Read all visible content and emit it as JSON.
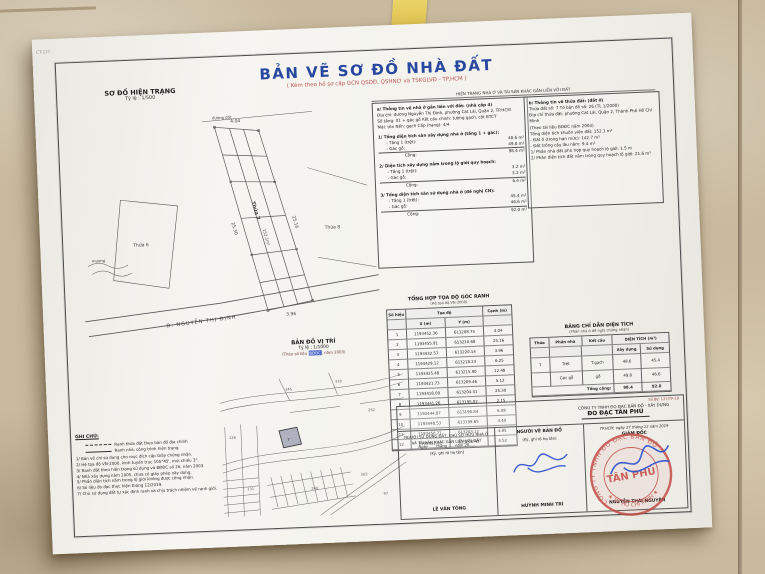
{
  "colors": {
    "title_blue": "#28479e",
    "accent_red": "#b9534f",
    "stamp_red": "#c0453e",
    "sig_blue": "#2b4fd0",
    "hl_blue": "#4a66c8"
  },
  "document": {
    "corner_mark": "CT-127",
    "title": "BẢN VẼ SƠ ĐỒ NHÀ ĐẤT",
    "subtitle": "( Kèm theo hồ sơ cấp GCN QSDĐ, QSHNƠ và TSKGLVĐ - TP.HCM )"
  },
  "hien_trang": {
    "heading": "SƠ ĐỒ HIỆN TRẠNG",
    "scale": "Tỷ lệ : 1/500",
    "plan": {
      "road_name": "Đ. NGUYỄN THỊ ĐỊNH",
      "parcel_label": "Thửa 7",
      "parcel_area": "152.1m²",
      "neighbor_left": "Thửa 6",
      "neighbor_right": "Thửa 8",
      "top_label": "đường đất",
      "ditch_label": "mương",
      "dim_top": "4.04",
      "dim_right": "25.16",
      "dim_left": "25.30",
      "dim_bottom": "3.96"
    }
  },
  "info_header": "HIỆN TRẠNG NHÀ Ở VÀ TÀI SẢN KHÁC GẮN LIỀN VỚI ĐẤT",
  "house_info": {
    "title": "a/ Thông tin về nhà ở gắn liền với đất: (nhà cấp 4)",
    "lines": [
      "Địa chỉ: đường Nguyễn Thị Định, phường Cát Lái, Quận 2, TP.HCM",
      "Số tầng: 01 + gác gỗ     Kết cấu chính: tường gạch, cột BTCT",
      "Mái: tôn     Nền: gạch     Cấp (hạng): 4/4"
    ],
    "blocks": [
      {
        "title": "1/ Tổng diện tích sàn xây dựng nhà ở (tầng 1 + gác):",
        "r1_label": "- Tầng 1 (trệt):",
        "r1_val": "48.6 m²",
        "r2_label": "- Gác gỗ:",
        "r2_val": "49.8 m²",
        "total_label": "Cộng:",
        "total": "98.4 m²"
      },
      {
        "title": "2/ Diện tích xây dựng nằm trong lộ giới quy hoạch:",
        "r1_label": "- Tầng 1 (trệt):",
        "r1_val": "3.2 m²",
        "r2_label": "- Gác gỗ:",
        "r2_val": "3.2 m²",
        "total_label": "Cộng:",
        "total": "6.4 m²"
      },
      {
        "title": "3/ Tổng diện tích sàn sử dụng nhà ở (đề nghị CN):",
        "r1_label": "- Tầng 1 (trệt):",
        "r1_val": "45.4 m²",
        "r2_label": "- Gác gỗ:",
        "r2_val": "46.6 m²",
        "total_label": "Cộng:",
        "total": "92.0 m²"
      }
    ]
  },
  "land_info": {
    "title": "b/ Thông tin về thửa đất: (đất ở)",
    "lines": [
      "Thửa đất số: 7      Tờ bản đồ số: 26 (TL 1/2000)",
      "Địa chỉ thửa đất: phường Cát Lái, Quận 2, Thành Phố Hồ Chí Minh",
      "(Theo tài liệu BĐĐC năm 2003)",
      "Tổng diện tích khuôn viên đất:  152.1 m²",
      "- Đất ở (trong hạn mức):  142.7 m²",
      "- Đất trồng cây lâu năm:  9.4 m²",
      "1/ Phần nhà đất phù hợp quy hoạch lộ giới:  1.5 m",
      "2/ Phần diện tích đất nằm trong quy hoạch lộ giới:  21.6 m²"
    ]
  },
  "coord_table": {
    "title": "TỔNG HỢP TỌA ĐỘ GÓC RANH",
    "subtitle": "(Hệ tọa độ VN-2000)",
    "headers": {
      "point": "Số hiệu",
      "coords": "Tọa độ",
      "x": "X (m)",
      "y": "Y (m)",
      "edge": "Cạnh (m)"
    },
    "rows": [
      {
        "n": "1",
        "x": "1193452.36",
        "y": "613208.75",
        "e": "4.04"
      },
      {
        "n": "2",
        "x": "1193455.91",
        "y": "613210.68",
        "e": "25.16"
      },
      {
        "n": "3",
        "x": "1193432.57",
        "y": "613220.14",
        "e": "3.96"
      },
      {
        "n": "4",
        "x": "1193429.12",
        "y": "613218.23",
        "e": "6.25"
      },
      {
        "n": "5",
        "x": "1193425.48",
        "y": "613215.90",
        "e": "12.48"
      },
      {
        "n": "6",
        "x": "1193421.73",
        "y": "613209.46",
        "e": "5.12"
      },
      {
        "n": "7",
        "x": "1193418.09",
        "y": "613204.31",
        "e": "25.30"
      },
      {
        "n": "8",
        "x": "1193441.26",
        "y": "613195.02",
        "e": "2.15"
      },
      {
        "n": "9",
        "x": "1193444.87",
        "y": "613196.84",
        "e": "6.08"
      },
      {
        "n": "10",
        "x": "1193448.53",
        "y": "613199.65",
        "e": "3.40"
      },
      {
        "n": "11",
        "x": "1193450.71",
        "y": "613203.12",
        "e": "4.85"
      },
      {
        "n": "12",
        "x": "1193452.02",
        "y": "613206.43",
        "e": "3.52"
      }
    ]
  },
  "area_table": {
    "title": "BẢNG CHỈ DẪN DIỆN TÍCH",
    "subtitle": "(Phần nhà ở đề nghị chứng nhận)",
    "headers": {
      "thua": "Thửa",
      "phan": "Phần nhà",
      "ketcau": "Kết cấu",
      "dt": "DIỆN TÍCH (m²)",
      "xd": "Xây dựng",
      "sd": "Sử dụng"
    },
    "rows": [
      {
        "thua": "7",
        "phan": "Trệt",
        "ketcau": "T.gạch",
        "xd": "48.6",
        "sd": "45.4"
      },
      {
        "thua": "",
        "phan": "Gác gỗ",
        "ketcau": "gỗ",
        "xd": "49.8",
        "sd": "46.6"
      }
    ],
    "total_label": "Tổng cộng:",
    "total_xd": "98.4",
    "total_sd": "92.0"
  },
  "vi_tri": {
    "heading": "BẢN ĐỒ VỊ TRÍ",
    "scale": "Tỷ lệ : 1/1000",
    "src_pre": "(Theo số liệu ",
    "src_hl": "BĐĐC",
    "src_post": ", năm 2003)",
    "parcel_numbers": [
      "126",
      "131",
      "245",
      "318",
      "252",
      "7",
      "240",
      "163",
      "97"
    ]
  },
  "ghi_chu": {
    "heading": "GHI CHÚ:",
    "legend": [
      {
        "text": "Ranh thửa đất theo bản đồ địa chính"
      },
      {
        "text": "Ranh nhà, công trình hiện trạng"
      }
    ],
    "notes": [
      "1/ Bản vẽ chỉ sử dụng cho mục đích cấp Giấy chứng nhận.",
      "2/ Hệ tọa độ VN-2000, kinh tuyến trục 105°45', múi chiếu 3°.",
      "3/ Ranh đất theo hiện trạng sử dụng và BĐĐC số 26, năm 2003.",
      "4/ Nhà xây dựng năm 2005, chưa có giấy phép xây dựng.",
      "5/ Phần diện tích nằm trong lộ giới không được công nhận.",
      "6/ Số liệu đo đạc thực hiện tháng 12/2019.",
      "7/ Chủ sử dụng đất tự xác định ranh và chịu trách nhiệm về ranh giới."
    ]
  },
  "signoff": {
    "doc_no": "Số BV: 127/TP-19",
    "company_line1": "CÔNG TY TNHH ĐO ĐẠC BẢN ĐỒ - XÂY DỰNG",
    "company_line2": "ĐO ĐẠC TÂN PHÚ",
    "col1_line1": "NGƯỜI SỬ DỤNG ĐẤT, CHỦ SỞ HỮU NHÀ Ở",
    "col1_line2": "VÀ TÀI SẢN KHÁC GẮN LIỀN VỚI ĐẤT",
    "col1_line3": "(Ký, ghi rõ họ tên)",
    "col1_date": "Ngày ..... tháng ..... năm 20.....",
    "col1_name": "LÊ VĂN TÒNG",
    "col2_line1": "NGƯỜI VẼ BẢN ĐỒ",
    "col2_line2": "(Ký, ghi rõ họ tên)",
    "col2_name": "HUỲNH MINH TRÍ",
    "col3_date": "TP.HCM, ngày 27 tháng 12 năm 2019",
    "col3_role": "GIÁM ĐỐC",
    "col3_name": "NGUYỄN THÁI NGUYÊN"
  },
  "stamp": {
    "ring_top": "CÔNG TY TNHH ĐO ĐẠC BẢN ĐỒ",
    "ring_bottom": "★ TP. HỒ CHÍ MINH ★",
    "center": "TÂN PHÚ"
  }
}
